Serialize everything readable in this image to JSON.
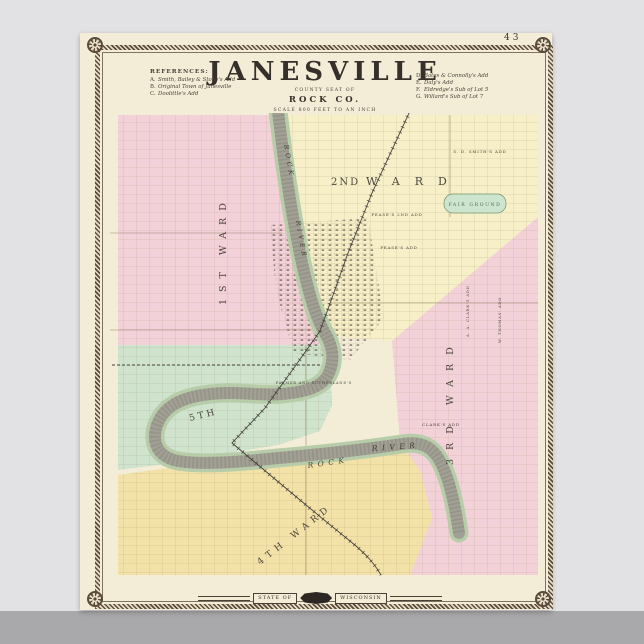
{
  "colors": {
    "background": "#e2e2e4",
    "floor": "#a9a9ab",
    "paper": "#f3edd8",
    "ink": "#36302a",
    "border": "#5a4b3a",
    "pink": "#f3d1d8",
    "cream": "#f6efc8",
    "green": "#cfe3cd",
    "yellow": "#f3e2a8",
    "river": "#a2a094",
    "bank": "#b7cda9",
    "rail": "#45403a",
    "road": "#8d7a5f",
    "fairground": "#cde4cf",
    "fairgroundtext": "#3e5a3c"
  },
  "page": {
    "number": "43"
  },
  "title": {
    "main": "JANESVILLE",
    "sub1": "COUNTY SEAT OF",
    "sub2": "ROCK CO.",
    "sub3": "SCALE 800 FEET TO AN INCH"
  },
  "references_left": {
    "header": "REFERENCES:",
    "items": [
      {
        "key": "A.",
        "label": "Smith, Bailey & Stone's Add"
      },
      {
        "key": "B.",
        "label": "Original Town of Janesville"
      },
      {
        "key": "C.",
        "label": "Doolittle's Add"
      }
    ]
  },
  "references_right": {
    "items": [
      {
        "key": "D.",
        "label": "Bates & Connolly's Add"
      },
      {
        "key": "E.",
        "label": "Daly's Add"
      },
      {
        "key": "F.",
        "label": "Eldredge's Sub of Lot 5"
      },
      {
        "key": "G.",
        "label": "Willard's Sub of Lot 7"
      }
    ]
  },
  "banner": {
    "left": "STATE OF",
    "right": "WISCONSIN"
  },
  "map": {
    "wards": {
      "w1": "1ST WARD",
      "w2_num": "2ND",
      "w2_name": "WARD",
      "w3": "3RD WARD",
      "w4": "4TH WARD",
      "w5": "5TH"
    },
    "river": {
      "upper1": "ROCK",
      "upper2": "RIVER",
      "lower1": "ROCK",
      "lower2": "RIVER"
    },
    "labels": {
      "fair_ground": "FAIR GROUND",
      "smith": "S. D. SMITH'S ADD",
      "pease2": "PEASE'S 2ND ADD",
      "pease": "PEASE'S ADD",
      "clark": "CLARK'S ADD",
      "aa_clark": "A. A. CLARK'S ADD",
      "thomas": "W. THOMAS' ADD",
      "palmer": "PALMER AND SUTHERLAND'S"
    }
  }
}
